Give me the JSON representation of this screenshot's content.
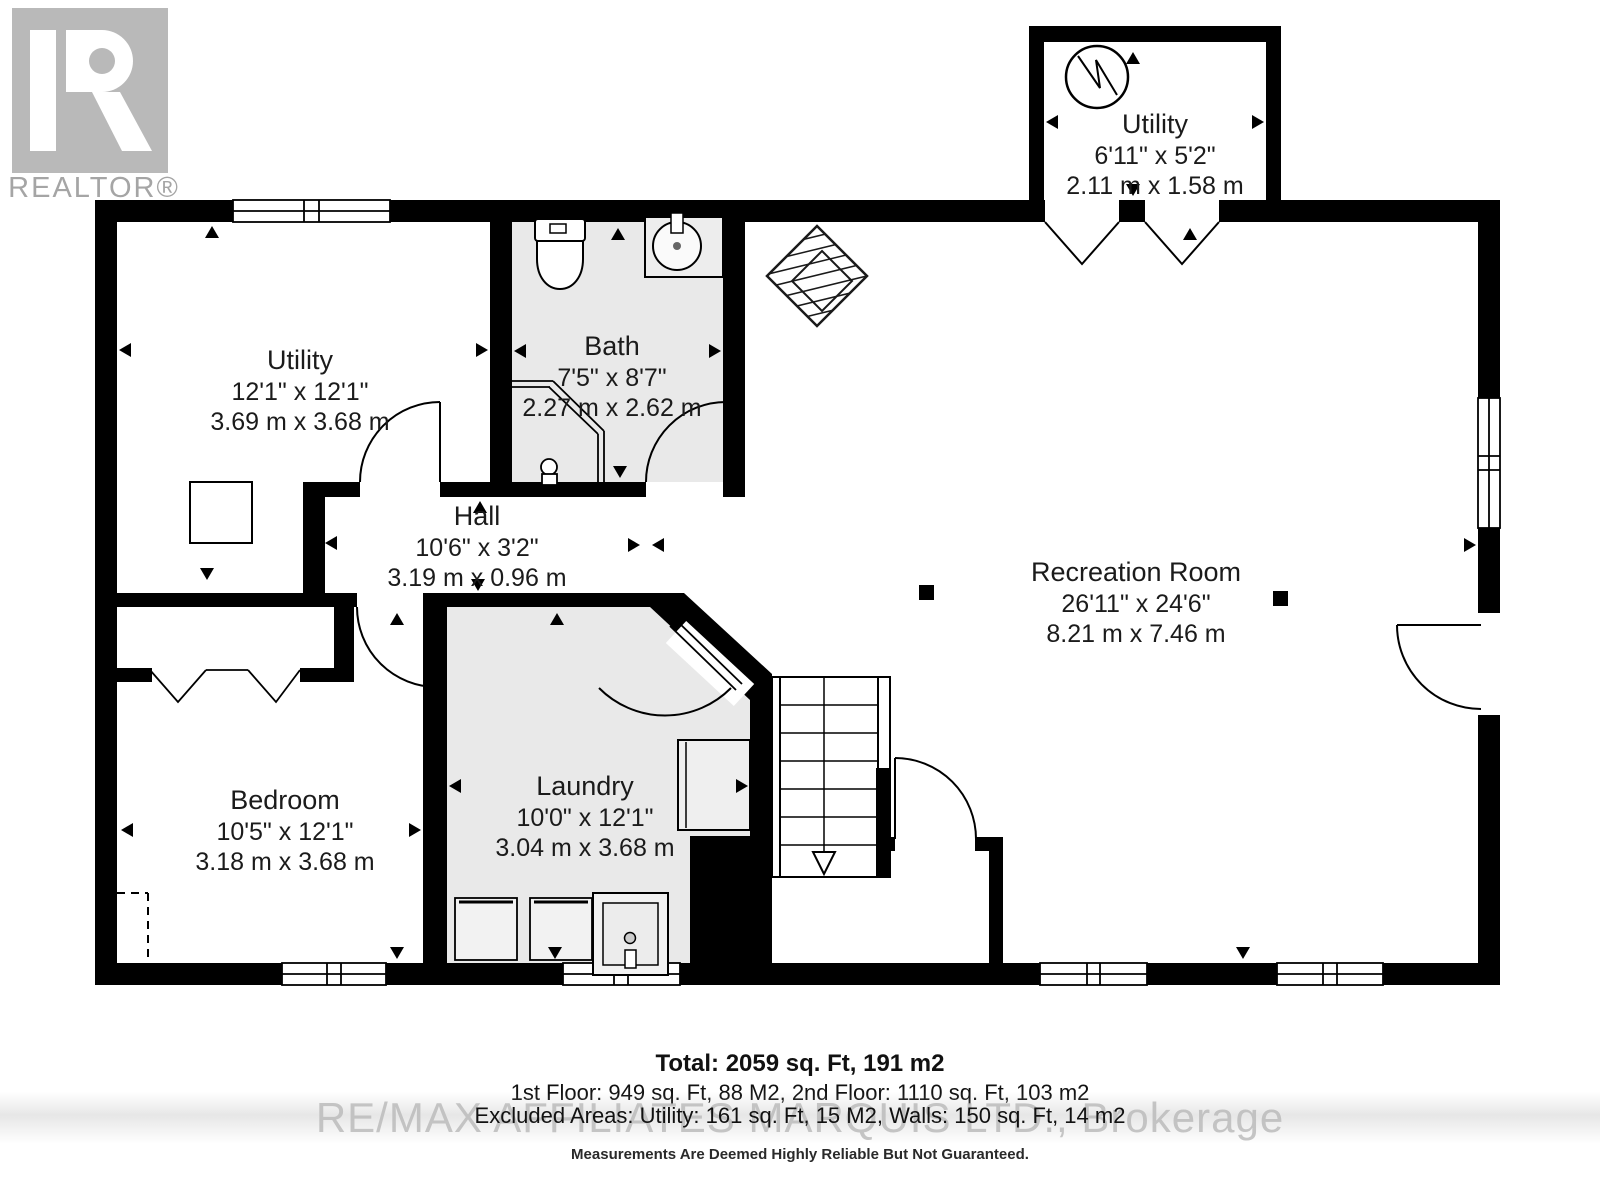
{
  "logo": {
    "text": "REALTOR®"
  },
  "rooms": {
    "utility_top": {
      "name": "Utility",
      "imperial": "6'11\" x 5'2\"",
      "metric": "2.11 m x 1.58 m"
    },
    "utility_left": {
      "name": "Utility",
      "imperial": "12'1\" x 12'1\"",
      "metric": "3.69 m x 3.68 m"
    },
    "bath": {
      "name": "Bath",
      "imperial": "7'5\" x 8'7\"",
      "metric": "2.27 m x 2.62 m"
    },
    "hall": {
      "name": "Hall",
      "imperial": "10'6\" x 3'2\"",
      "metric": "3.19 m x 0.96 m"
    },
    "recreation": {
      "name": "Recreation Room",
      "imperial": "26'11\" x 24'6\"",
      "metric": "8.21 m x 7.46 m"
    },
    "bedroom": {
      "name": "Bedroom",
      "imperial": "10'5\" x 12'1\"",
      "metric": "3.18 m x 3.68 m"
    },
    "laundry": {
      "name": "Laundry",
      "imperial": "10'0\" x 12'1\"",
      "metric": "3.04 m x 3.68 m"
    }
  },
  "footer": {
    "total": "Total: 2059 sq. Ft, 191 m2",
    "floors": "1st Floor: 949 sq. Ft, 88 M2, 2nd Floor: 1110 sq. Ft, 103 m2",
    "excluded": "Excluded Areas: Utility: 161 sq. Ft, 15 M2, Walls: 150 sq. Ft, 14 m2",
    "watermark": "RE/MAX AFFILIATES MARQUIS LTD., Brokerage",
    "disclaimer": "Measurements Are Deemed Highly Reliable But Not Guaranteed."
  },
  "colors": {
    "wall": "#000000",
    "room_fill": "#e9e9e9",
    "logo_gray": "#b9b9b9",
    "text": "#1b1b1b",
    "watermark_gray": "#bcbcbc"
  }
}
